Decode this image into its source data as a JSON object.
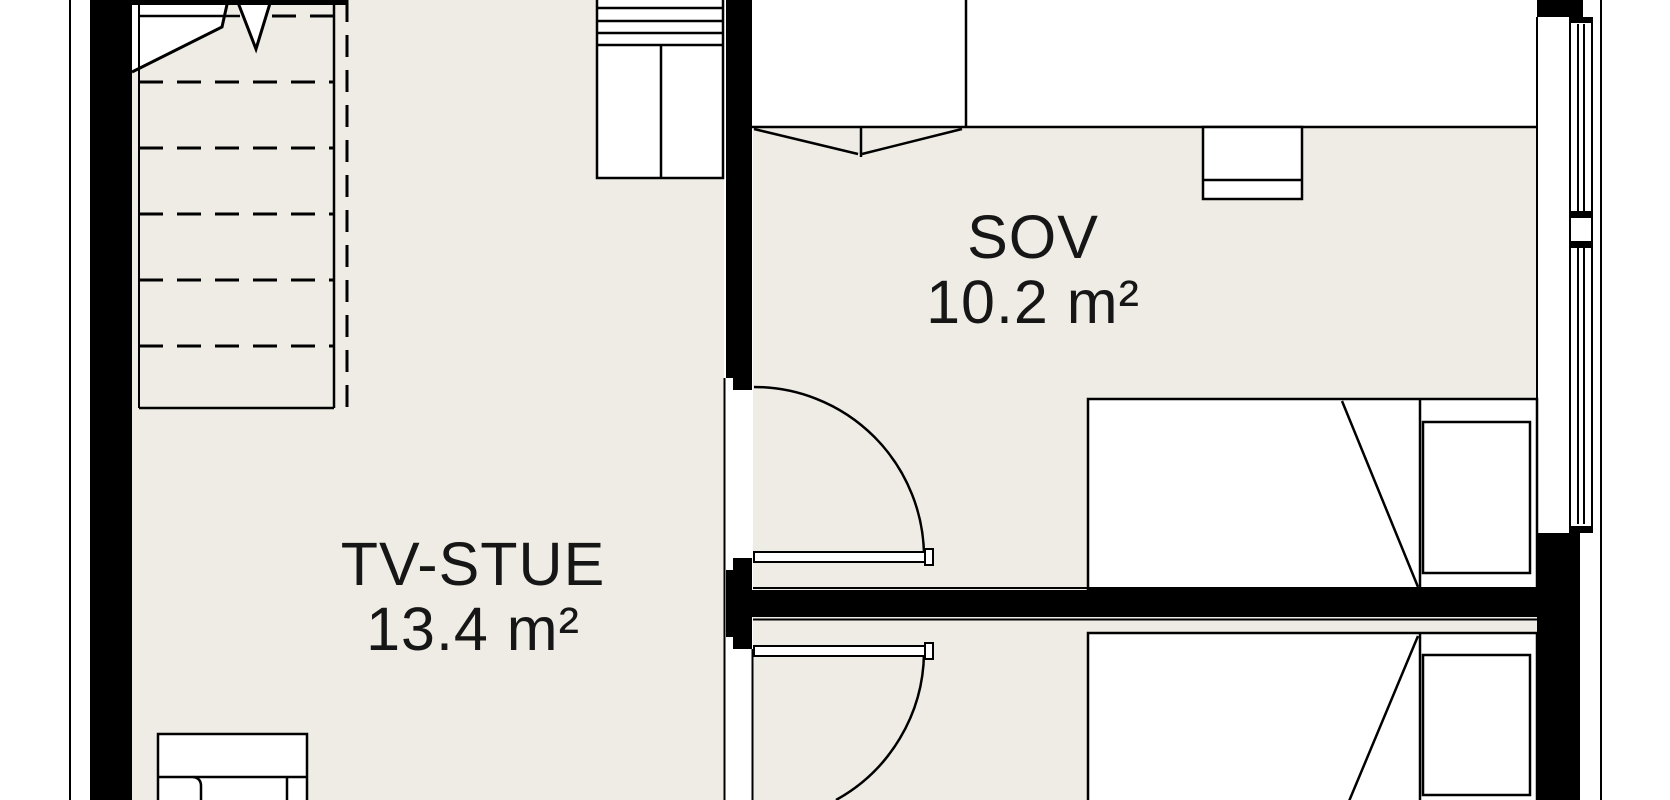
{
  "plan": {
    "type": "floor-plan",
    "rooms": [
      {
        "id": "tv-stue",
        "name": "TV-STUE",
        "area": "13.4 m²"
      },
      {
        "id": "sov",
        "name": "SOV",
        "area": "10.2 m²"
      }
    ],
    "visible_elements": [
      "staircase-with-break-line",
      "wardrobe",
      "closet-with-double-doors",
      "wall-cabinet",
      "single-bed-sov",
      "single-bed-lower-room",
      "sofa",
      "swing-door-sov",
      "swing-door-lower-room",
      "window-right-wall"
    ],
    "colors": {
      "floor": "#eeece4",
      "line": "#000000",
      "background": "#ffffff"
    }
  }
}
